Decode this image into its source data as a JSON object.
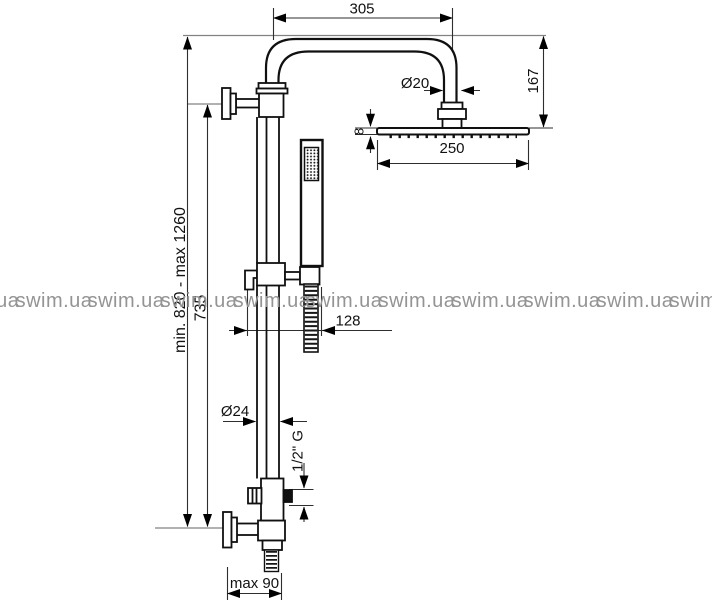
{
  "drawing": {
    "type": "shower column technical drawing",
    "dimensions": {
      "arm_length": "305",
      "arm_pipe_diameter": "Ø20",
      "head_drop_height": "167",
      "head_thickness": "8",
      "head_width": "250",
      "column_height_range": "min. 820 - max 1260",
      "inlet_to_top_height": "735",
      "hose_offset": "128",
      "column_pipe_diameter": "Ø24",
      "outlet_thread": "1/2\" G",
      "wall_distance": "max 90"
    }
  },
  "watermark": {
    "text": "swim.ua"
  }
}
